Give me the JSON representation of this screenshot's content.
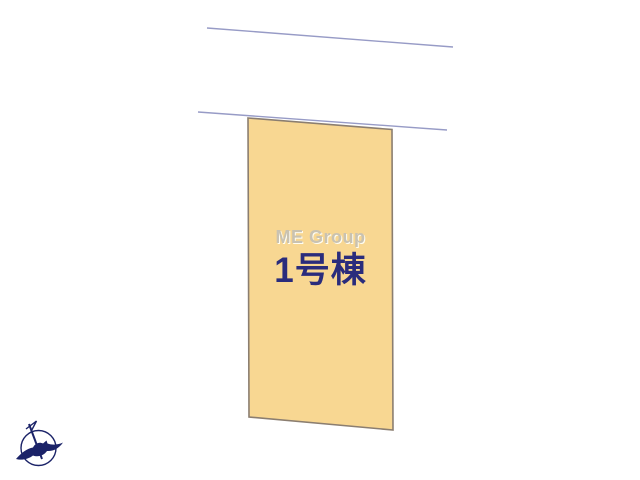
{
  "plan": {
    "watermark_text": "ME Group",
    "lot": {
      "label": "1号棟"
    },
    "colors": {
      "background": "#ffffff",
      "lot_fill": "#F8D792",
      "lot_border": "#8B7E70",
      "lot_label_text": "#2A2C7C",
      "watermark_text": "#C9C2B1",
      "road_line": "#979BC6",
      "compass": "#1B2368"
    }
  }
}
